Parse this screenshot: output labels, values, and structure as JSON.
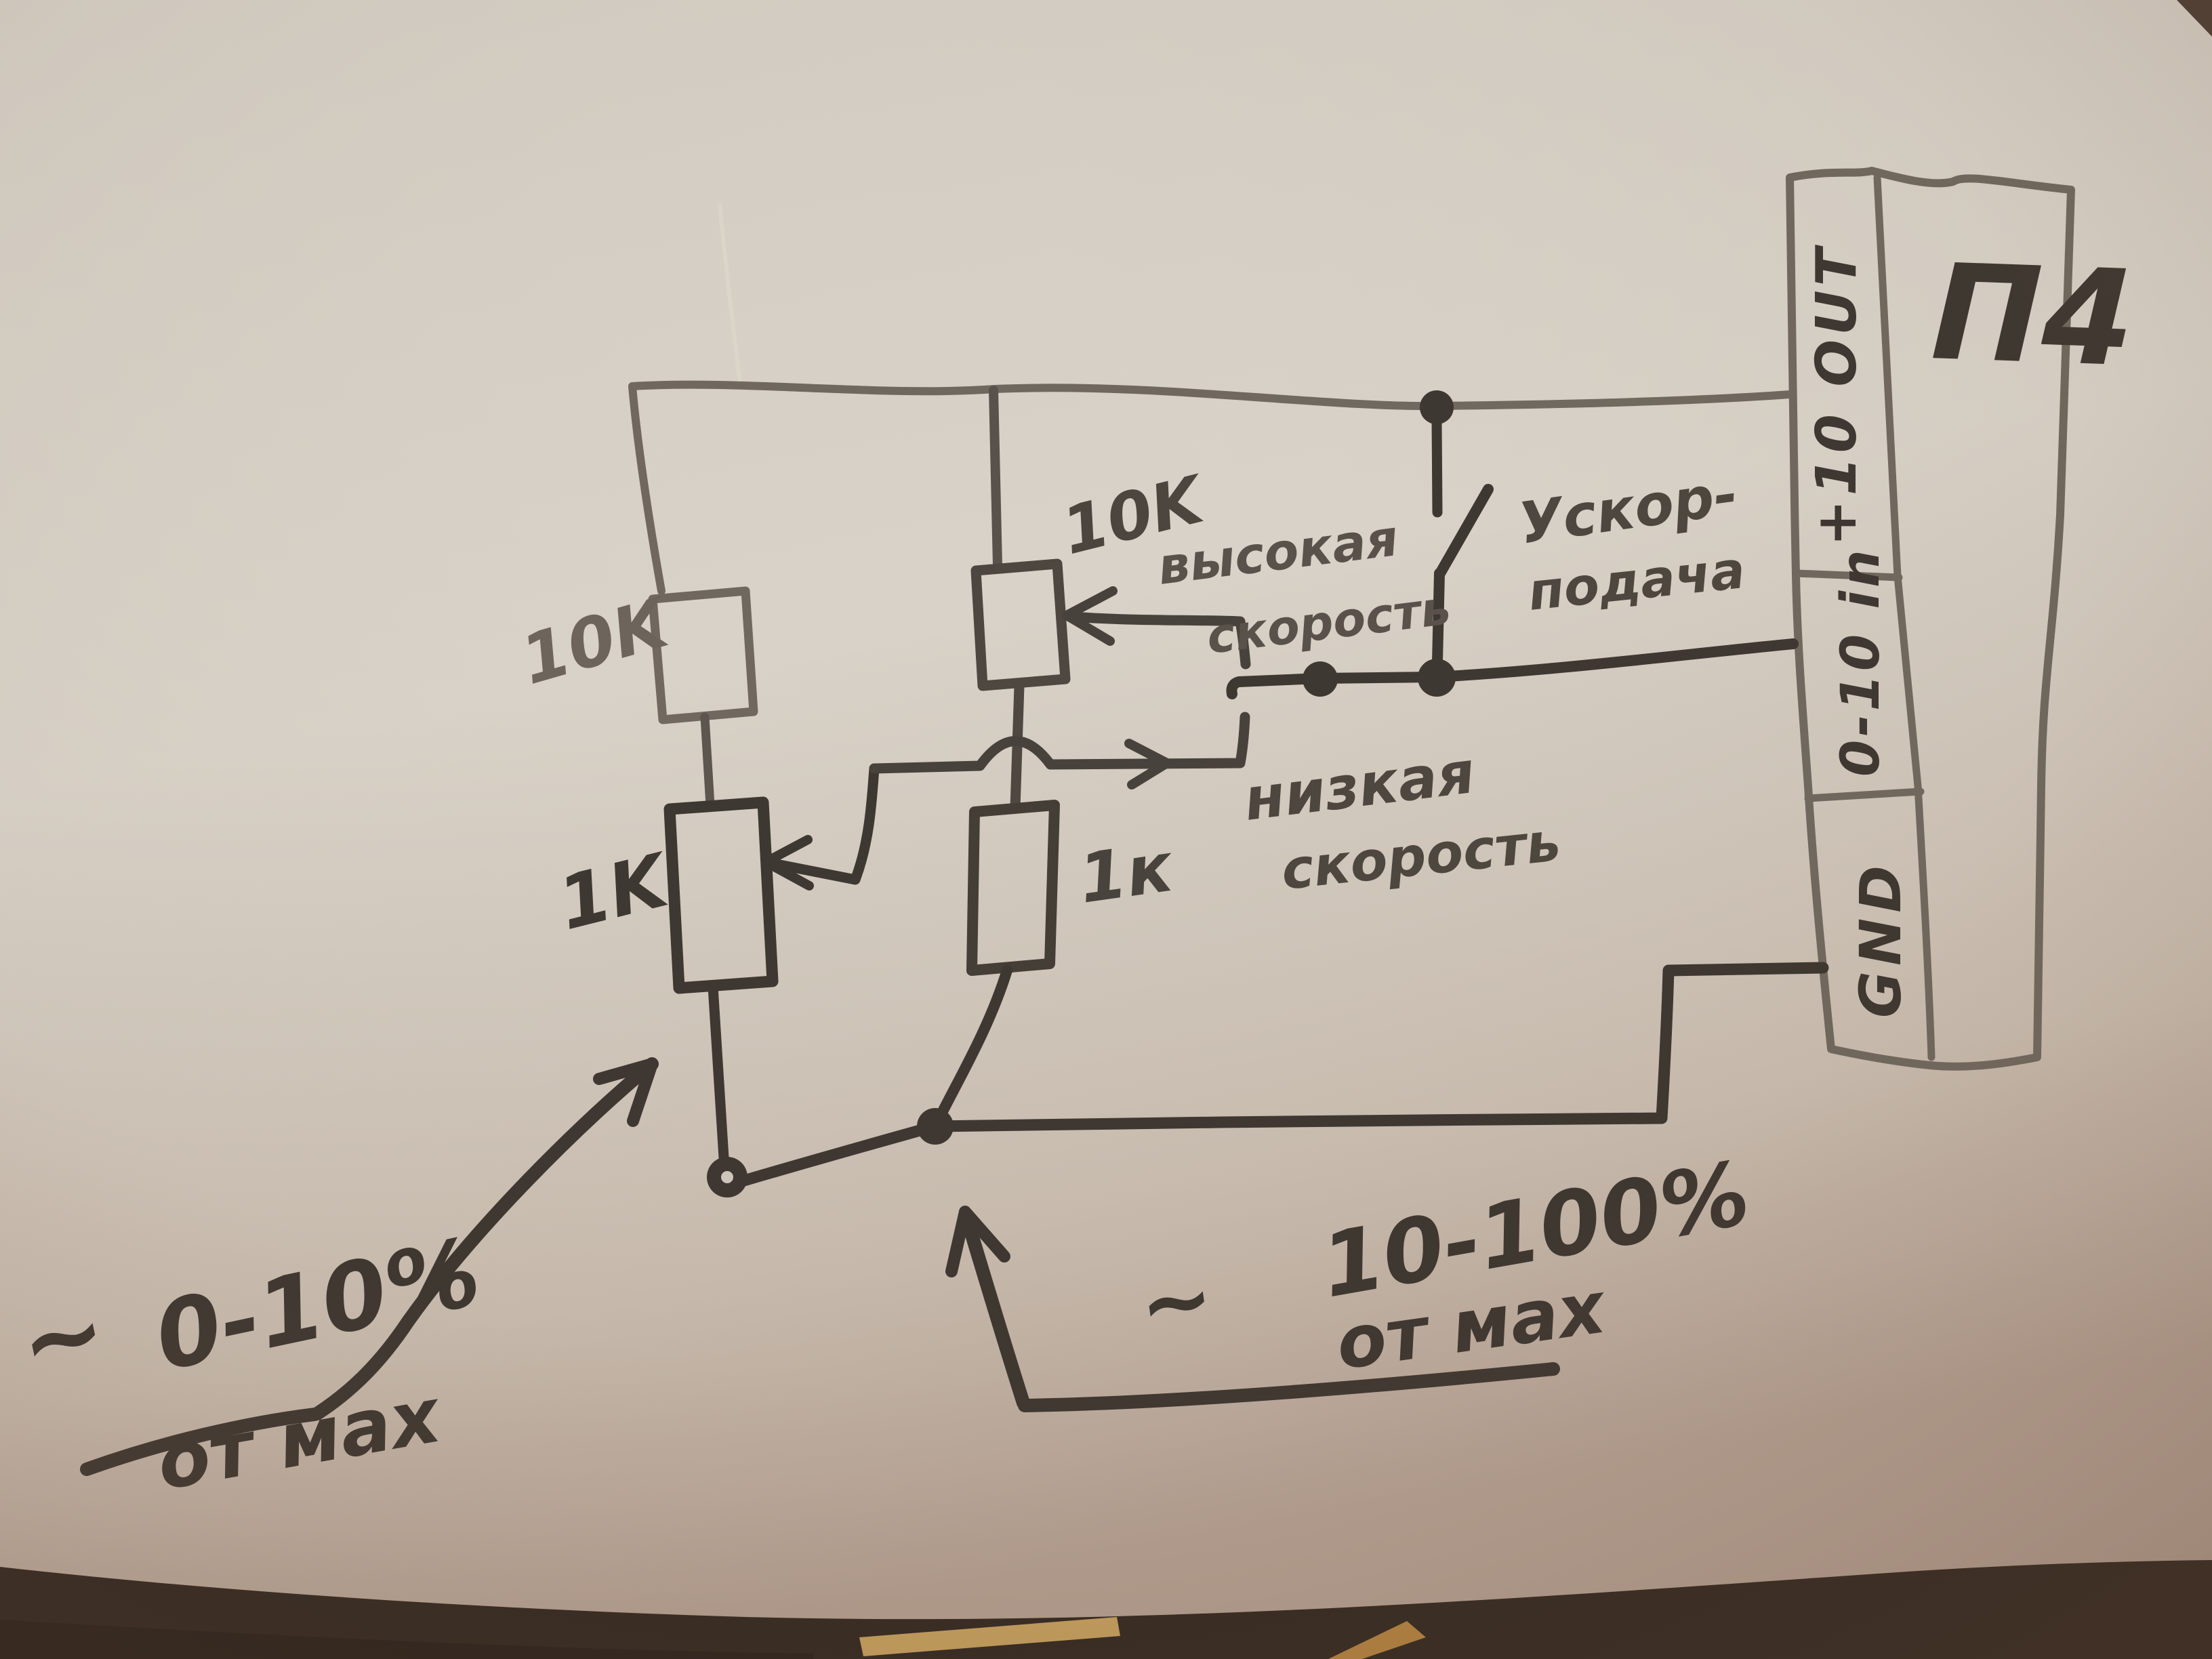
{
  "scene": {
    "description": "Hand-drawn pencil schematic on paper: two-speed potentiometer control wired to a drive terminal strip",
    "device_label": "П4"
  },
  "terminals": [
    {
      "id": "plus10out",
      "label": "+10 OUT"
    },
    {
      "id": "analog_in",
      "label": "0-10 in"
    },
    {
      "id": "gnd",
      "label": "GND"
    }
  ],
  "components": {
    "resistor_top_left": "10K",
    "pot_left": "1K",
    "pot_center": "10K",
    "resistor_center": "1к"
  },
  "labels": {
    "high_speed": {
      "line1": "высокая",
      "line2": "скорость"
    },
    "low_speed": {
      "line1": "низкая",
      "line2": "скорость"
    },
    "rapid_feed": {
      "line1": "Ускор-",
      "line2": "подача"
    }
  },
  "annotations": {
    "left": {
      "tilde": "~",
      "value": "0-10%",
      "suffix": "от мах"
    },
    "right": {
      "tilde": "~",
      "value": "10-100%",
      "suffix": "от мах"
    }
  },
  "colors": {
    "paper": "#d6d0c6",
    "pencil": "#6e675d",
    "marker": "#3b352f",
    "fabric": "#2c241e",
    "stick": "#c9a35f"
  }
}
